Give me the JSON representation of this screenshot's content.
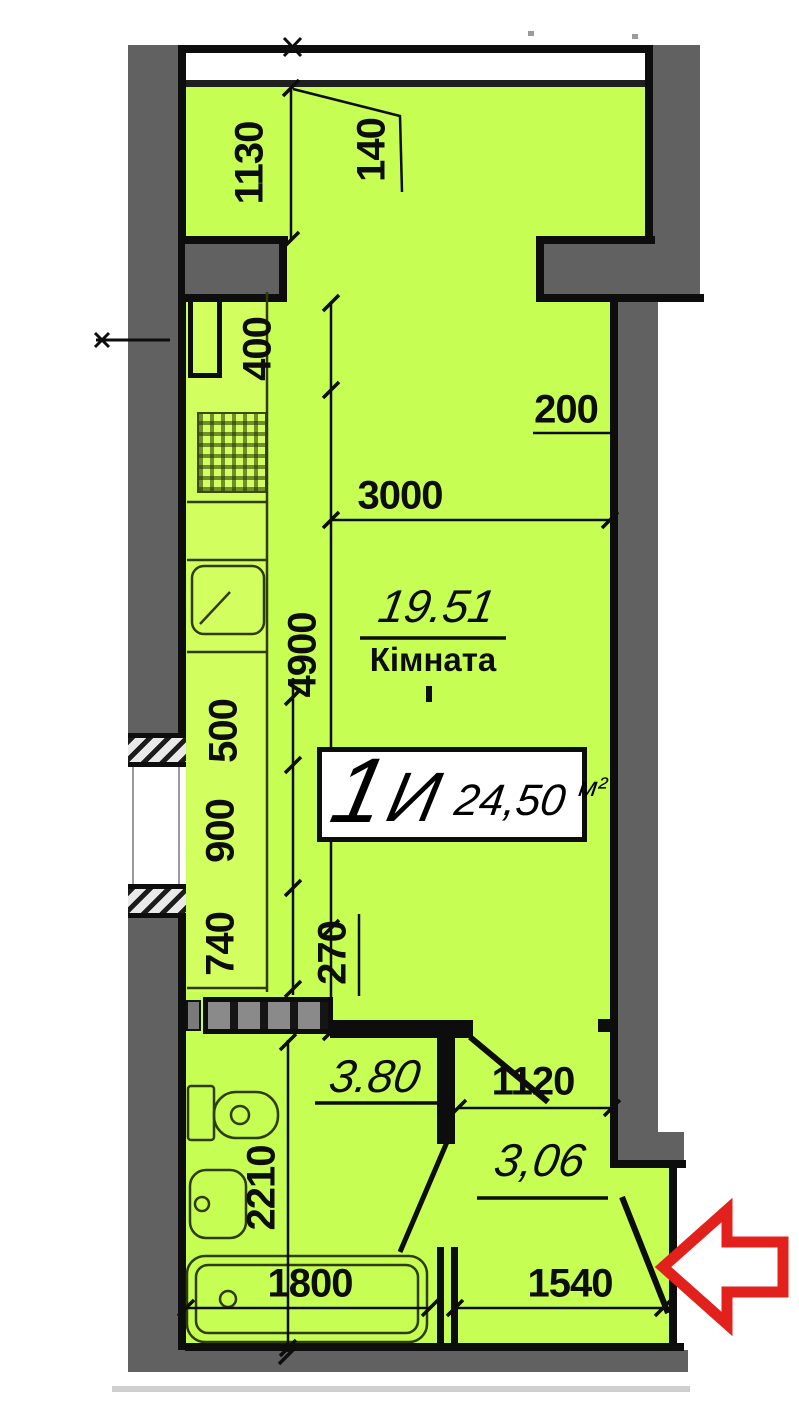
{
  "plan": {
    "title_block": {
      "unit_number": "1",
      "unit_series": "И",
      "area_value": "24,50",
      "area_unit": "м²"
    },
    "main_room": {
      "area": "19.51",
      "name": "Кімната"
    },
    "bathroom": {
      "area": "3.80"
    },
    "hallway": {
      "area": "3,06"
    },
    "dimensions": {
      "d1130": "1130",
      "d140": "140",
      "d400": "400",
      "d200": "200",
      "d3000": "3000",
      "d4900": "4900",
      "d500": "500",
      "d900": "900",
      "d740": "740",
      "d270": "270",
      "d2210": "2210",
      "d1800": "1800",
      "d1120": "1120",
      "d1540": "1540"
    },
    "colors": {
      "floor": "#c6fe53",
      "wall": "#616161",
      "line": "#0d0d0d",
      "arrow": "#e3211c"
    }
  }
}
